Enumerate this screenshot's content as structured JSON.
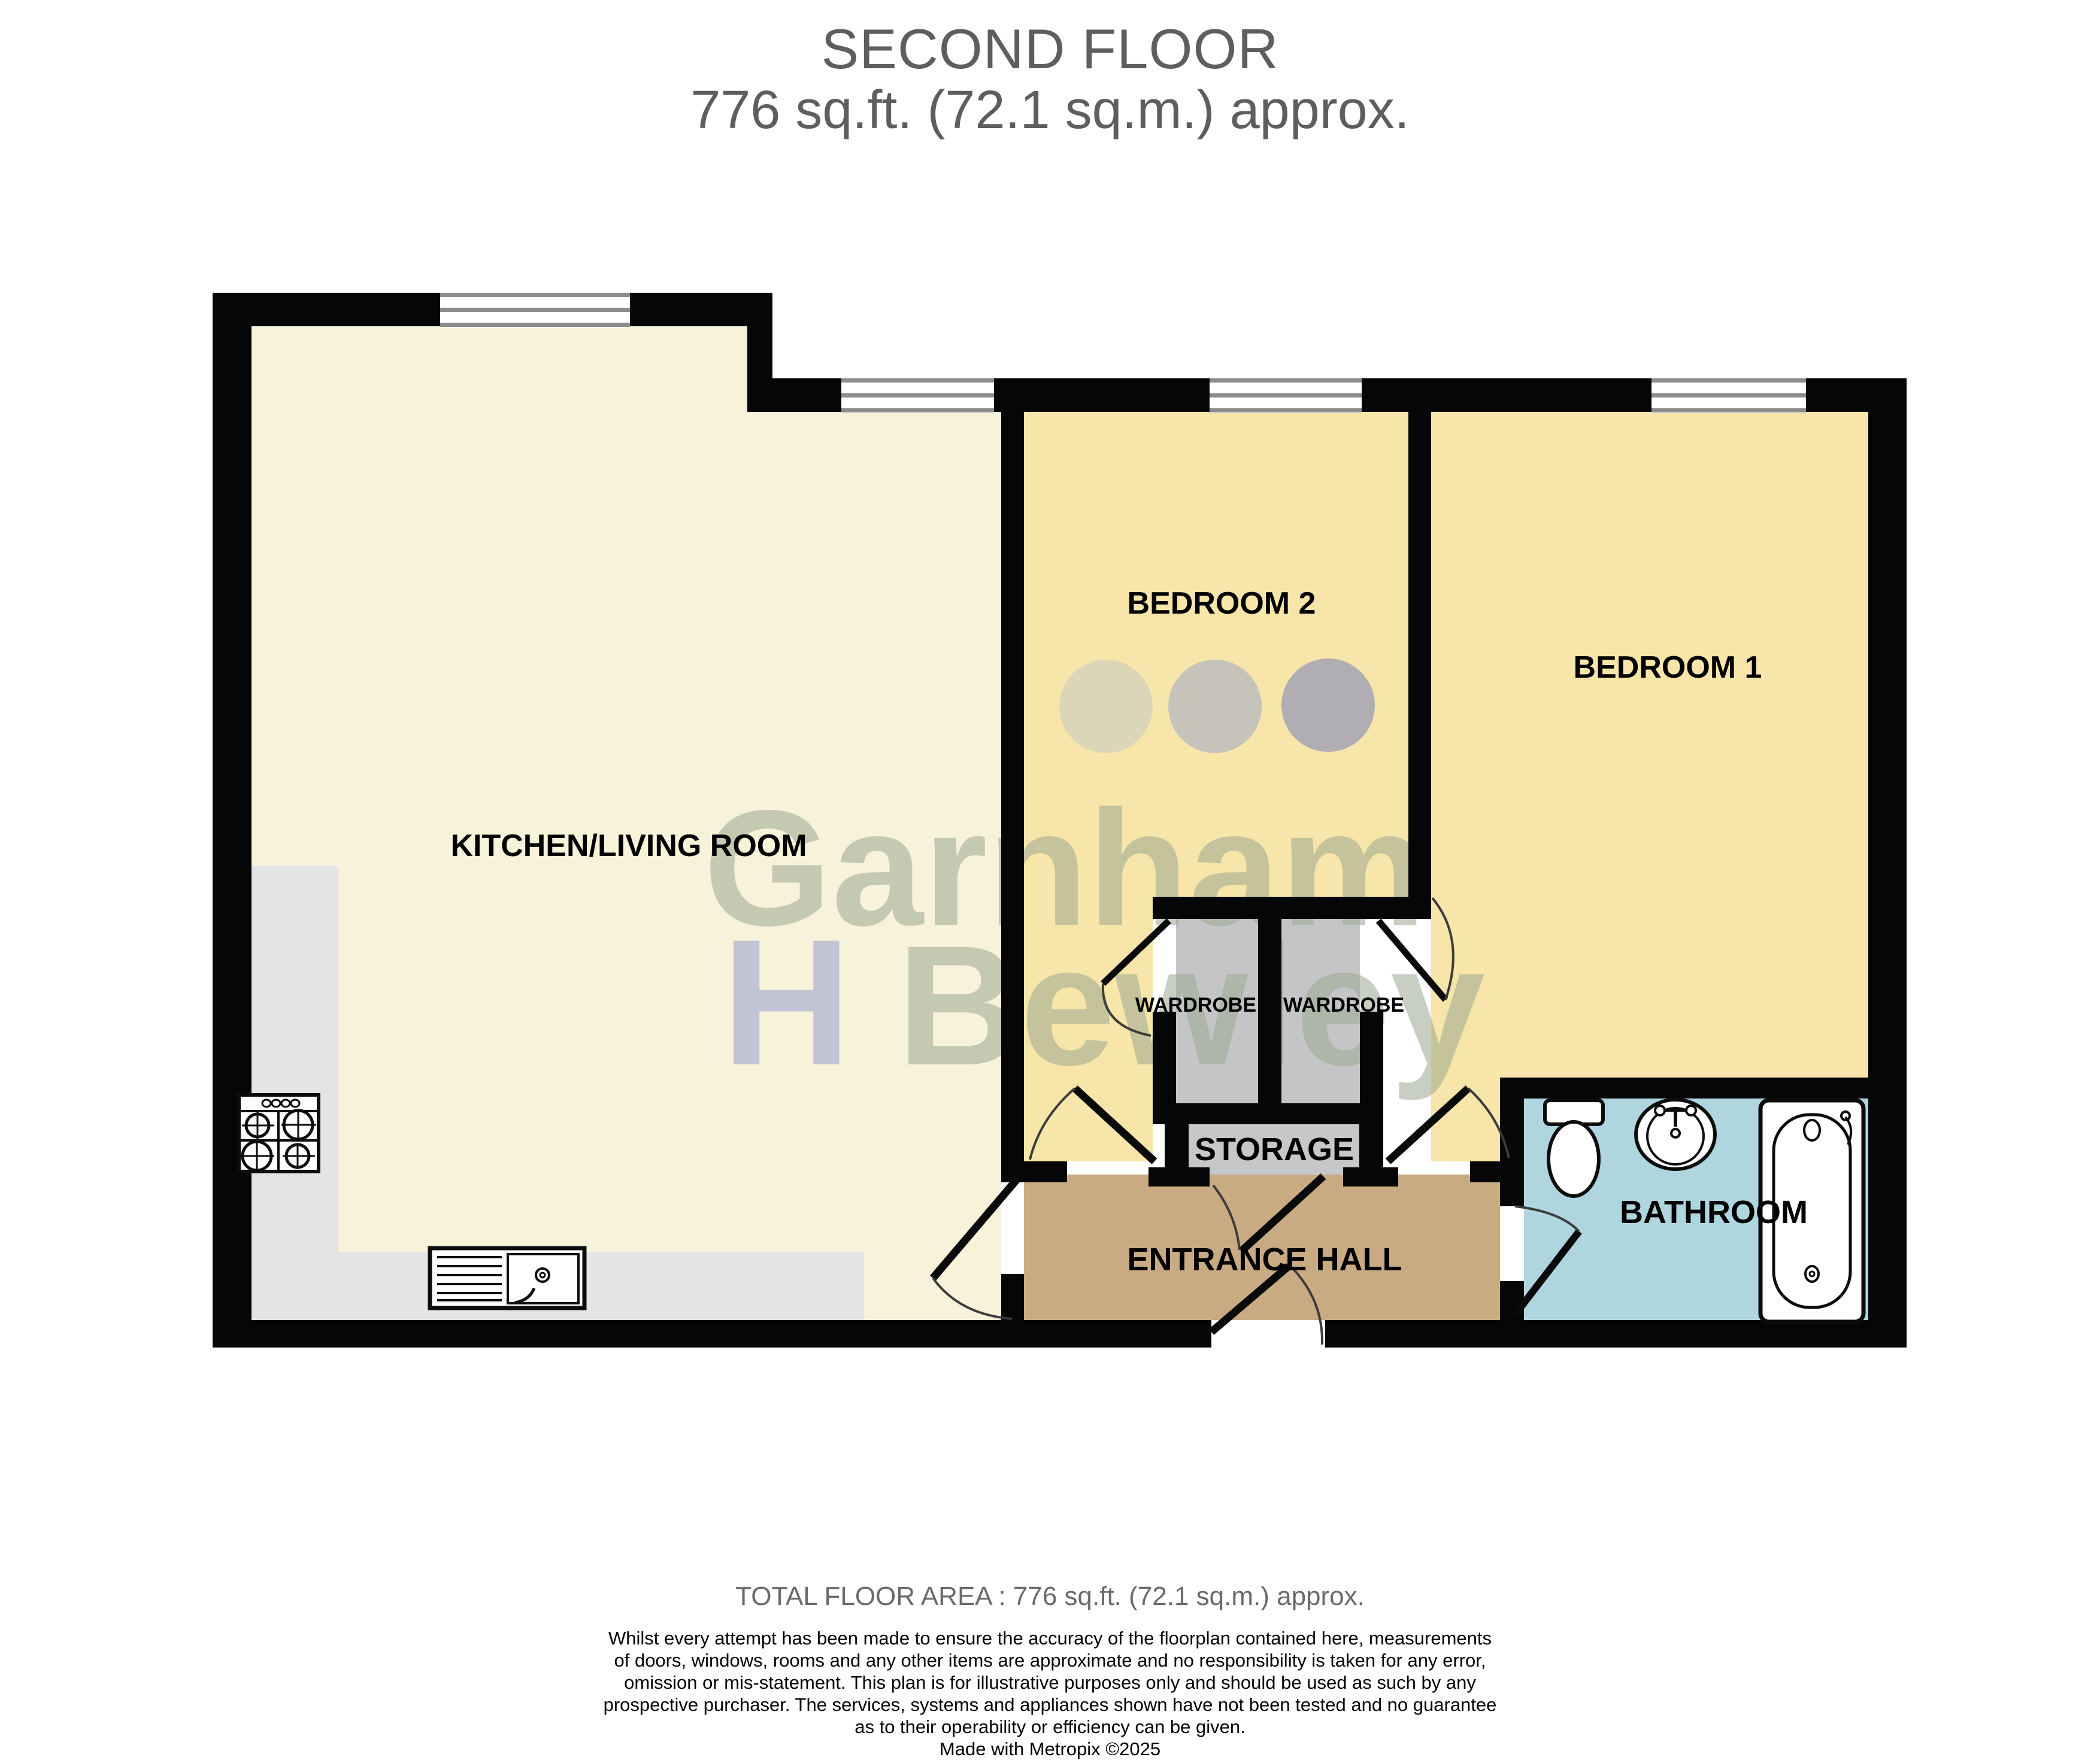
{
  "header": {
    "title": "SECOND FLOOR",
    "subtitle": "776 sq.ft. (72.1 sq.m.) approx."
  },
  "rooms": {
    "kitchen_living": "KITCHEN/LIVING ROOM",
    "bedroom2": "BEDROOM 2",
    "bedroom1": "BEDROOM 1",
    "wardrobe_left": "WARDROBE",
    "wardrobe_right": "WARDROBE",
    "storage": "STORAGE",
    "entrance_hall": "ENTRANCE HALL",
    "bathroom": "BATHROOM"
  },
  "watermark": {
    "word_top": "Garnham",
    "initial": "H",
    "word_bottom": "Bewley"
  },
  "footer": {
    "total_area": "TOTAL FLOOR AREA : 776 sq.ft. (72.1 sq.m.) approx.",
    "disclaimer": [
      "Whilst every attempt has been made to ensure the accuracy of the floorplan contained here, measurements",
      "of doors, windows, rooms and any other items are approximate and no responsibility is taken for any error,",
      "omission or mis-statement. This plan is for illustrative purposes only and should be used as such by any",
      "prospective purchaser. The services, systems and appliances shown have not been tested and no guarantee",
      "as to their operability or efficiency can be given."
    ],
    "credit": "Made with Metropix ©2025"
  },
  "colors": {
    "kitchen_living": "#f8f2da",
    "bedroom": "#f7e5a9",
    "entrance_hall": "#c9ab83",
    "bathroom": "#afd6de",
    "storage": "#c7c7c9",
    "wardrobe": "#c5c5c7",
    "counter": "#e4e4e6",
    "wall": "#060606",
    "window_line": "#8c8c8c",
    "watermark_green": "#9aa88f",
    "watermark_blue": "#8a96cf"
  }
}
